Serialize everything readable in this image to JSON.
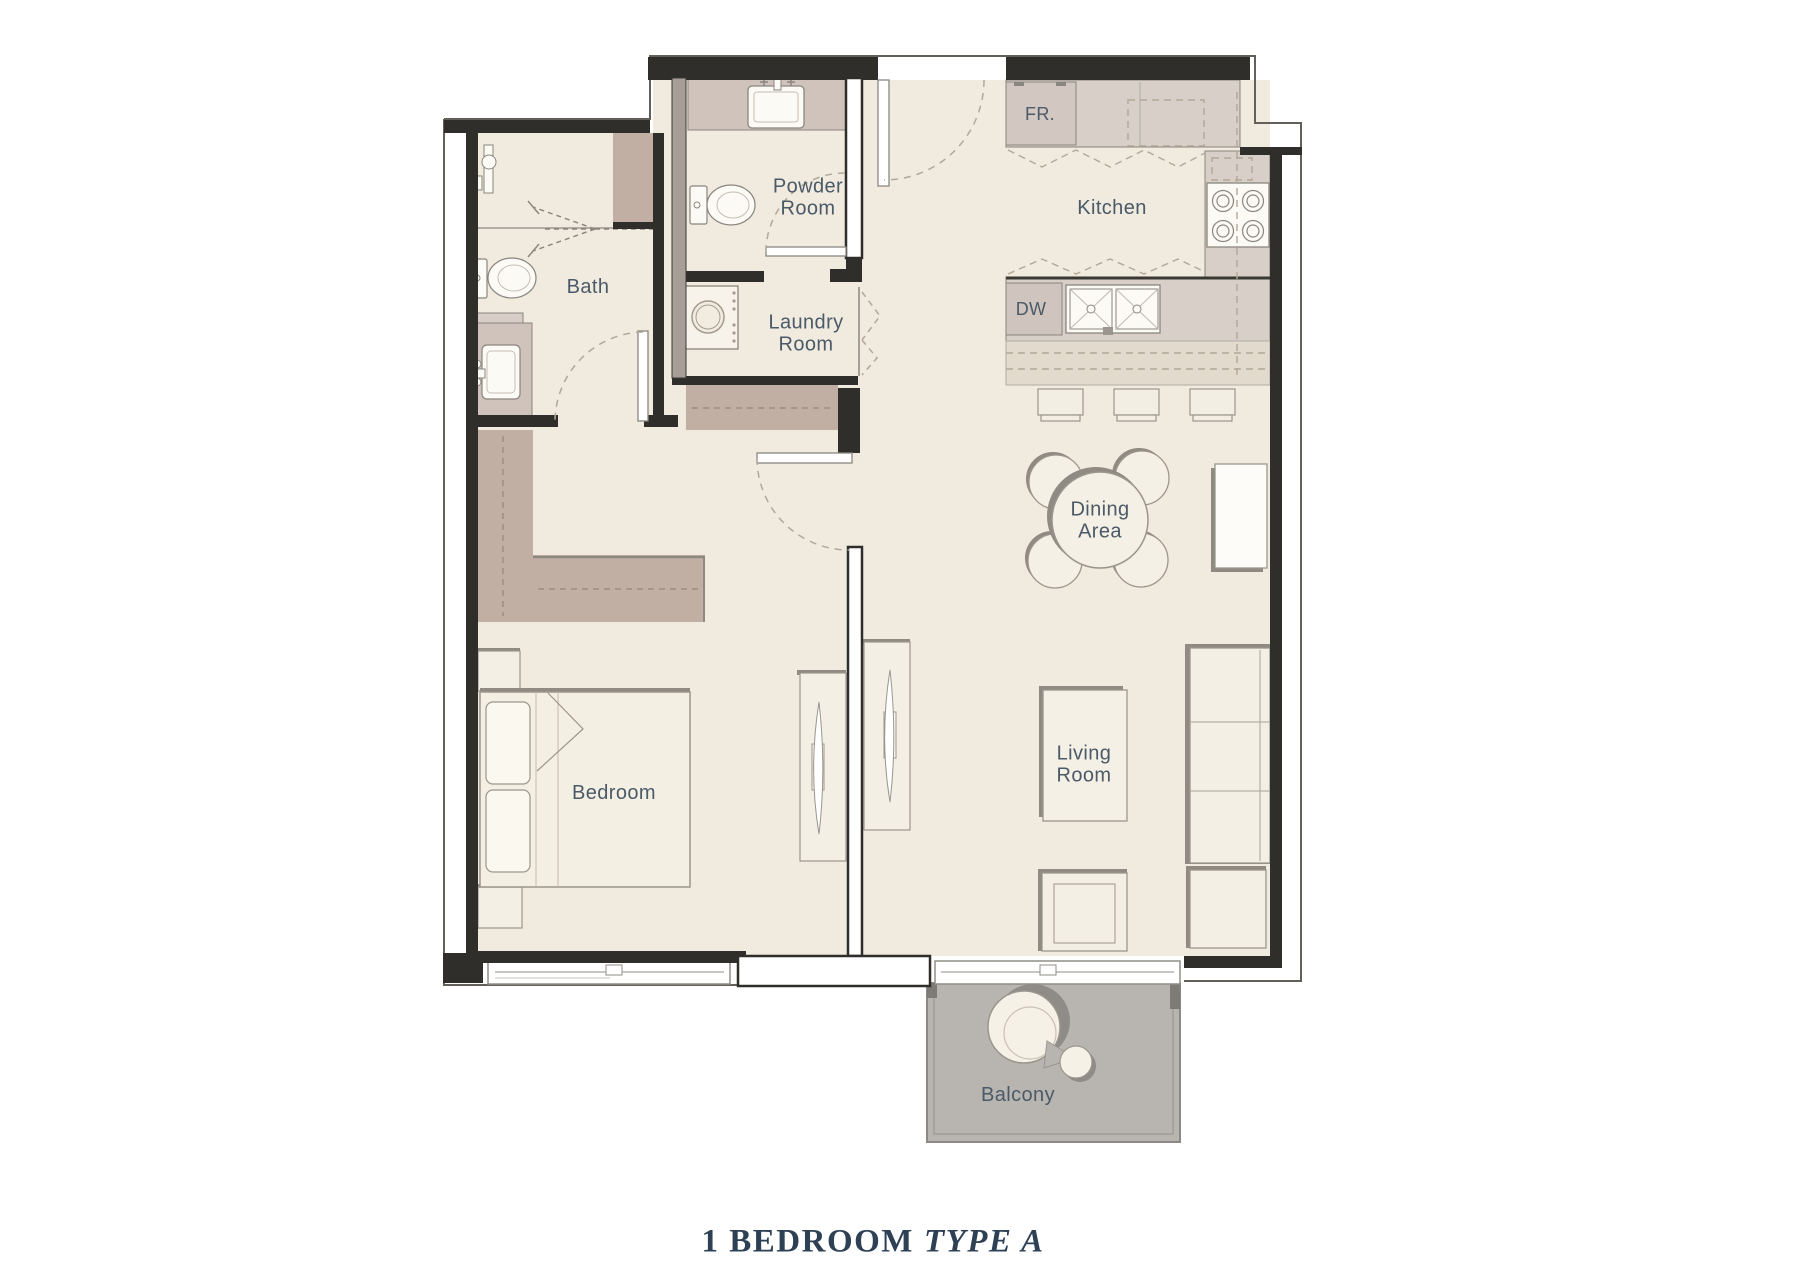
{
  "title": {
    "main": "1 BEDROOM",
    "variant": "TYPE A"
  },
  "rooms": {
    "bath": "Bath",
    "powder": "Powder\nRoom",
    "laundry": "Laundry\nRoom",
    "kitchen": "Kitchen",
    "fridge": "FR.",
    "dishwasher": "DW",
    "dining": "Dining\nArea",
    "bedroom": "Bedroom",
    "living": "Living\nRoom",
    "balcony": "Balcony"
  },
  "colors": {
    "floor": "#f0eadf",
    "wall": "#2f2e2a",
    "counter": "#d7cfc8",
    "wardrobe": "#c2afa4",
    "balcony_floor": "#b8b5b0",
    "fixture_white": "#fcfaf5",
    "label_text": "#4a5a68",
    "title_text": "#2e4054"
  }
}
